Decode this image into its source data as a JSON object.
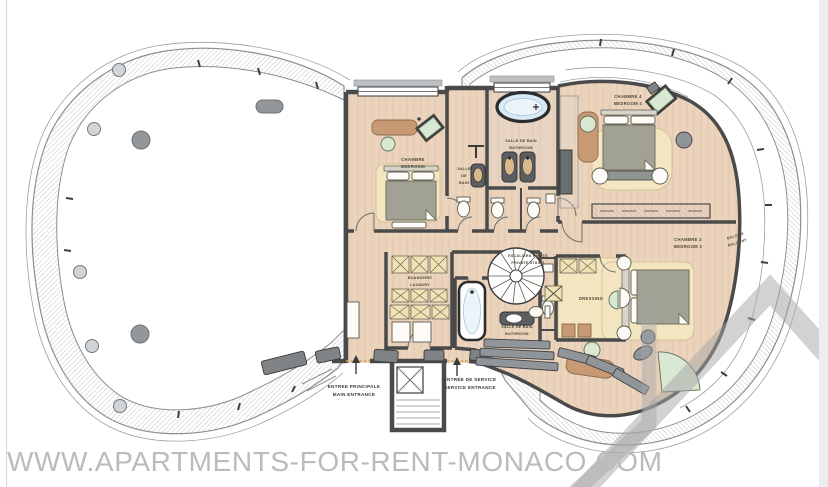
{
  "watermark": {
    "site": "WWW.APARTMENTS-FOR-RENT-MONACO.COM"
  },
  "rooms": {
    "bedroom1": {
      "fr": "CHAMBRE",
      "en": "BEDROOM"
    },
    "bath_strip": {
      "line1": "SALLE",
      "line2": "DE",
      "line3": "BAIN"
    },
    "bath_top": {
      "fr": "SALLE DE BAIN",
      "en": "BATHROOM"
    },
    "bedroom4": {
      "fr": "CHAMBRE 4",
      "en": "BEDROOM 4"
    },
    "bedroom3": {
      "fr": "CHAMBRE 3",
      "en": "BEDROOM 3"
    },
    "balcony": {
      "fr": "BALCON",
      "en": "BALCONY"
    },
    "dressing": {
      "fr": "DRESSING"
    },
    "laundry": {
      "fr": "BUANDERIE",
      "en": "LAUNDRY"
    },
    "private_stairs": {
      "fr": "ESCALIERS PRIVES",
      "en": "PRIVATE STAIRS"
    },
    "bath_lower": {
      "fr": "SALLE DE BAIN",
      "en": "BATHROOM"
    },
    "main_entrance": {
      "fr": "ENTREE PRINCIPALE",
      "en": "MAIN ENTRANCE"
    },
    "service_entrance": {
      "fr": "ENTRÉE DE SERVICE",
      "en": "SERVICE ENTRANCE"
    }
  },
  "colors": {
    "floor": "#ecd3bc",
    "rug": "#f2e5bf",
    "wall": "#4a4a4a",
    "wood": "#c79a74",
    "green": "#d9e8d3",
    "tub_water": "#d8ebf4",
    "fixture_gray": "#90959a",
    "hatch": "#a8acb0",
    "label_text": "#4a473b",
    "watermark_text": "#b9bbbf",
    "watermark_mark": "#a5a5a6"
  }
}
